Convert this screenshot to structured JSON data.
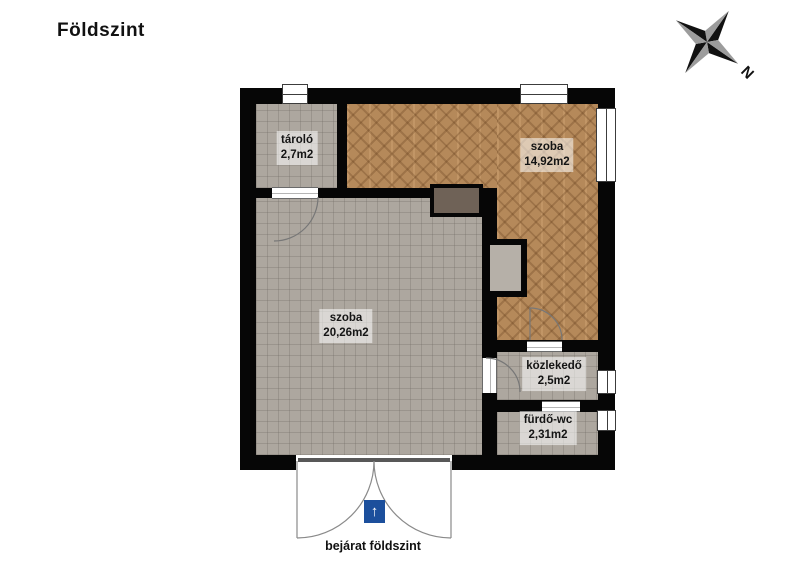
{
  "title": "Földszint",
  "compass": {
    "north_label": "N"
  },
  "rooms": [
    {
      "id": "tarolo",
      "name": "tároló",
      "area": "2,7m2",
      "floor": "gray-tile"
    },
    {
      "id": "szoba-felso",
      "name": "szoba",
      "area": "14,92m2",
      "floor": "brown-parquet"
    },
    {
      "id": "szoba-nagy",
      "name": "szoba",
      "area": "20,26m2",
      "floor": "gray-tile"
    },
    {
      "id": "kozlekedo",
      "name": "közlekedő",
      "area": "2,5m2",
      "floor": "gray-tile"
    },
    {
      "id": "furdo-wc",
      "name": "fürdő-wc",
      "area": "2,31m2",
      "floor": "gray-tile"
    }
  ],
  "entrance": {
    "label": "bejárat földszint",
    "icon": "arrow-up-icon",
    "icon_glyph": "↑"
  },
  "colors": {
    "wall": "#060606",
    "tile_floor": "#ada79f",
    "parquet_floor": "#b5895a",
    "fireplace": "#6f6257",
    "entrance_icon_bg": "#1c4f9c",
    "door_arc": "#777777",
    "compass_dark": "#111111",
    "compass_light": "#9c9c9c"
  }
}
